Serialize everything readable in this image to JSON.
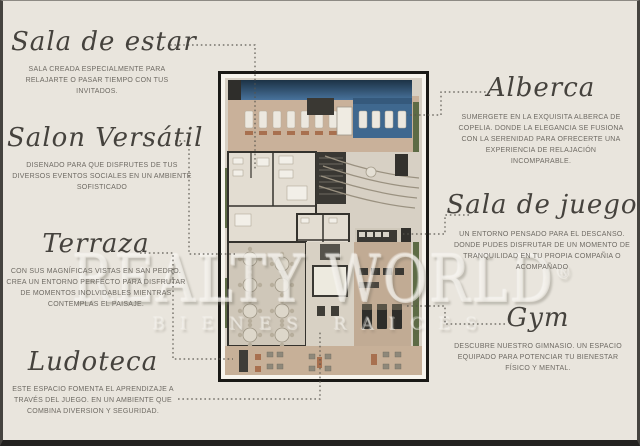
{
  "watermark": {
    "text": "REALTY WORLD",
    "registered": "®",
    "tagline": "BIENES RAICES"
  },
  "labels": [
    {
      "id": "sala-de-estar",
      "title": "Sala de estar",
      "description": "SALA CREADA ESPECIALMENTE PARA RELAJARTE O PASAR TIEMPO CON TUS INVITADOS."
    },
    {
      "id": "salon-versatil",
      "title": "Salon Versátil",
      "description": "DISENADO PARA QUE DISFRUTES DE TUS DIVERSOS EVENTOS SOCIALES EN UN AMBIENTE SOFISTICADO"
    },
    {
      "id": "terraza",
      "title": "Terraza",
      "description": "CON SUS MAGNÍFICAS VISTAS EN SAN PEDRO. CREA UN ENTORNO PERFECTO PARA DISFRUTAR DE MOMENTOS INOLVIDABLES MIENTRAS CONTEMPLAS EL PAISAJE."
    },
    {
      "id": "ludoteca",
      "title": "Ludoteca",
      "description": "ESTE ESPACIO FOMENTA EL APRENDIZAJE A TRAVÉS DEL JUEGO. EN UN AMBIENTE QUE COMBINA DIVERSION Y SEGURIDAD."
    },
    {
      "id": "alberca",
      "title": "Alberca",
      "description": "SUMERGETE EN LA EXQUISITA ALBERCA DE COPELIA. DONDE LA ELEGANCIA SE FUSIONA CON LA SERENIDAD PARA OFRECERTE UNA EXPERIENCIA DE RELAJACIÓN INCOMPARABLE."
    },
    {
      "id": "sala-de-juego",
      "title": "Sala de juego",
      "description": "UN ENTORNO PENSADO PARA EL DESCANSO. DONDE PUDES DISFRUTAR DE UN MOMENTO DE TRANQUILIDAD EN TU PROPIA COMPAÑIA O ACOMPAÑADO"
    },
    {
      "id": "gym",
      "title": "Gym",
      "description": "DESCUBRE NUESTRO GIMNASIO. UN ESPACIO EQUIPADO PARA POTENCIAR TU BIENESTAR FÍSICO Y MENTAL."
    }
  ],
  "colors": {
    "background": "#e9e5dd",
    "title_text": "#45423d",
    "body_text": "#6e6a63",
    "connector": "#57544d",
    "plan_frame": "#1a1916",
    "pool_blue": "#48729b",
    "deck_tan": "#c9b19a",
    "wall_dark": "#34322d",
    "greenery": "#5d6b45"
  }
}
